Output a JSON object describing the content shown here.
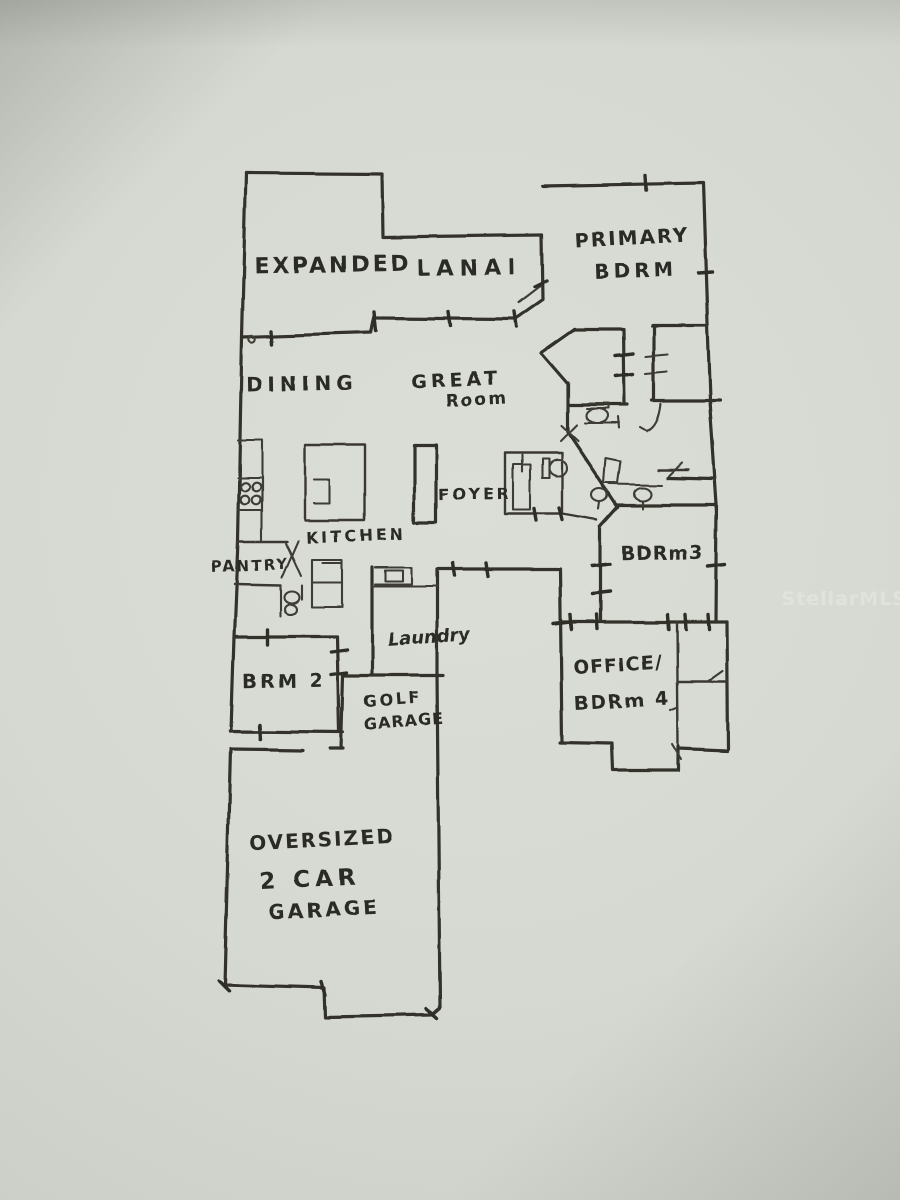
{
  "floorplan": {
    "watermark": "StellarMLS",
    "rooms": {
      "lanai_word1": "EXPANDED",
      "lanai_word2": "LANAI",
      "primary_line1": "PRIMARY",
      "primary_line2": "BDRM",
      "dining": "DINING",
      "great_line1": "GREAT",
      "great_line2": "Room",
      "foyer": "FOYER",
      "kitchen": "KITCHEN",
      "pantry": "PANTRY",
      "bdrm3": "BDRm3",
      "laundry": "Laundry",
      "brm2": "BRM 2",
      "golf_line1": "GOLF",
      "golf_line2": "GARAGE",
      "office_line1": "OFFICE/",
      "office_line2": "BDRm 4",
      "garage_line1": "OVERSIZED",
      "garage_line2": "2 CAR",
      "garage_line3": "GARAGE"
    },
    "colors": {
      "paper": "#d6d8d2",
      "ink": "#32312b",
      "watermark_text": "#eef0ea"
    }
  }
}
